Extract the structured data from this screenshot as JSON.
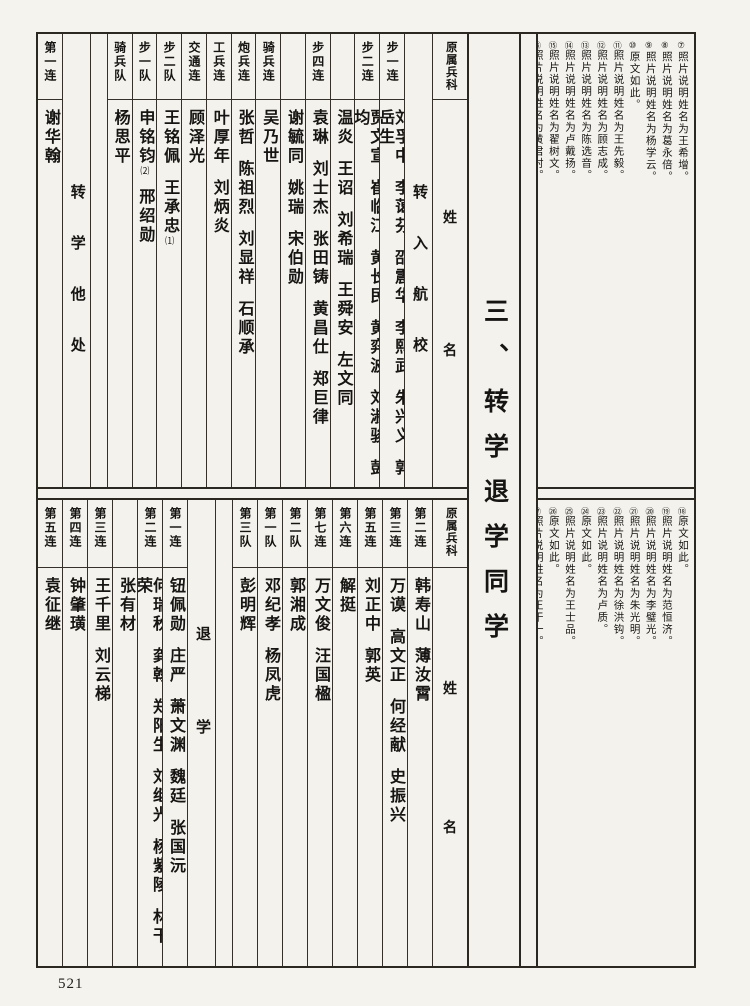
{
  "page": {
    "number": "521"
  },
  "title": "三、转学退学同学",
  "tables": {
    "top": {
      "columns": [
        {
          "kind": "name",
          "header": "第一连",
          "names": [
            "谢华翰"
          ]
        },
        {
          "kind": "category",
          "text": "转学他处"
        },
        {
          "kind": "spacer"
        },
        {
          "kind": "name",
          "header": "骑兵队",
          "names": [
            "杨思平"
          ]
        },
        {
          "kind": "name",
          "header": "步一队",
          "names": [
            "申铭钧|⑵",
            "邢绍勋"
          ]
        },
        {
          "kind": "name",
          "header": "步二队",
          "names": [
            "王铭佩",
            "王承忠|⑴"
          ]
        },
        {
          "kind": "name",
          "header": "交通连",
          "names": [
            "顾泽光"
          ]
        },
        {
          "kind": "name",
          "header": "工兵连",
          "names": [
            "叶厚年",
            "刘炳炎"
          ]
        },
        {
          "kind": "name",
          "header": "炮兵连",
          "names": [
            "张哲",
            "陈祖烈",
            "刘显祥",
            "石顺承"
          ]
        },
        {
          "kind": "name",
          "header": "骑兵连",
          "names": [
            "吴乃世"
          ]
        },
        {
          "kind": "name",
          "header": "",
          "names": [
            "谢毓同",
            "姚瑞",
            "宋伯勋"
          ]
        },
        {
          "kind": "name",
          "header": "步四连",
          "names": [
            "袁琳",
            "刘士杰",
            "张田铸",
            "黄昌仕",
            "郑巨律"
          ]
        },
        {
          "kind": "name",
          "header": "",
          "names": [
            "温炎",
            "王诏",
            "刘希瑞",
            "王舜安",
            "左文同"
          ]
        },
        {
          "kind": "name",
          "header": "步二连",
          "names": [
            "贾文宣",
            "崔临江",
            "黄长民",
            "黄弈波",
            "刘淑骏",
            "彭均"
          ]
        },
        {
          "kind": "name",
          "header": "步一连",
          "names": [
            "刘孚中",
            "李蔼芬",
            "邵震华",
            "李熙武",
            "朱兴义",
            "郭岳生"
          ]
        },
        {
          "kind": "category",
          "text": "转入航校"
        },
        {
          "kind": "origin",
          "header": "原属兵科",
          "labels": [
            "姓",
            "名"
          ]
        }
      ]
    },
    "bottom": {
      "columns": [
        {
          "kind": "name",
          "header": "第五连",
          "names": [
            "袁征继"
          ]
        },
        {
          "kind": "name",
          "header": "第四连",
          "names": [
            "钟肇璜"
          ]
        },
        {
          "kind": "name",
          "header": "第三连",
          "names": [
            "王千里",
            "刘云梯"
          ]
        },
        {
          "kind": "name",
          "header": "",
          "names": [
            "张有材"
          ]
        },
        {
          "kind": "name",
          "header": "第二连",
          "names": [
            "何瑞秋",
            "龚翰",
            "郑阳生",
            "刘继光",
            "杨紫陵",
            "林干荣"
          ]
        },
        {
          "kind": "name",
          "header": "第一连",
          "names": [
            "钮佩勋",
            "庄严",
            "萧文渊",
            "魏廷",
            "张国沅"
          ]
        },
        {
          "kind": "category",
          "text": "退学"
        },
        {
          "kind": "spacer"
        },
        {
          "kind": "name",
          "header": "第三队",
          "names": [
            "彭明辉"
          ]
        },
        {
          "kind": "name",
          "header": "第一队",
          "names": [
            "邓纪孝",
            "杨凤虎"
          ]
        },
        {
          "kind": "name",
          "header": "第二队",
          "names": [
            "郭湘成"
          ]
        },
        {
          "kind": "name",
          "header": "第七连",
          "names": [
            "万文俊",
            "汪国楹"
          ]
        },
        {
          "kind": "name",
          "header": "第六连",
          "names": [
            "解挺"
          ]
        },
        {
          "kind": "name",
          "header": "第五连",
          "names": [
            "刘正中",
            "郭英"
          ]
        },
        {
          "kind": "name",
          "header": "第三连",
          "names": [
            "万谟",
            "高文正",
            "何经献",
            "史振兴"
          ]
        },
        {
          "kind": "name",
          "header": "第二连",
          "names": [
            "韩寿山",
            "薄汝霄"
          ]
        },
        {
          "kind": "origin",
          "header": "原属兵科",
          "labels": [
            "姓",
            "名"
          ]
        }
      ]
    }
  },
  "notes": {
    "top": [
      "⑦照片说明姓名为王希增。",
      "⑧照片说明姓名为葛永倍。",
      "⑨照片说明姓名为杨学云。",
      "⑩原文如此。",
      "⑪照片说明姓名为王先毅。",
      "⑫照片说明姓名为顾志成。",
      "⑬照片说明姓名为陈选音。",
      "⑭照片说明姓名为卢戴扬。",
      "⑮照片说明姓名为翟树文。",
      "⑯照片说明姓名为黄君村。",
      "⑰照片说明姓名为曹文护。"
    ],
    "bottom": [
      "⑱原文如此。",
      "⑲照片说明姓名为范恒济。",
      "⑳照片说明姓名为李璧光。",
      "㉑照片说明姓名为朱光明。",
      "㉒照片说明姓名为徐洪钩。",
      "㉓照片说明姓名为卢质。",
      "㉔原文如此。",
      "㉕照片说明姓名为王士品。",
      "㉖原文如此。",
      "㉗照片说明姓名为王干一。"
    ]
  }
}
